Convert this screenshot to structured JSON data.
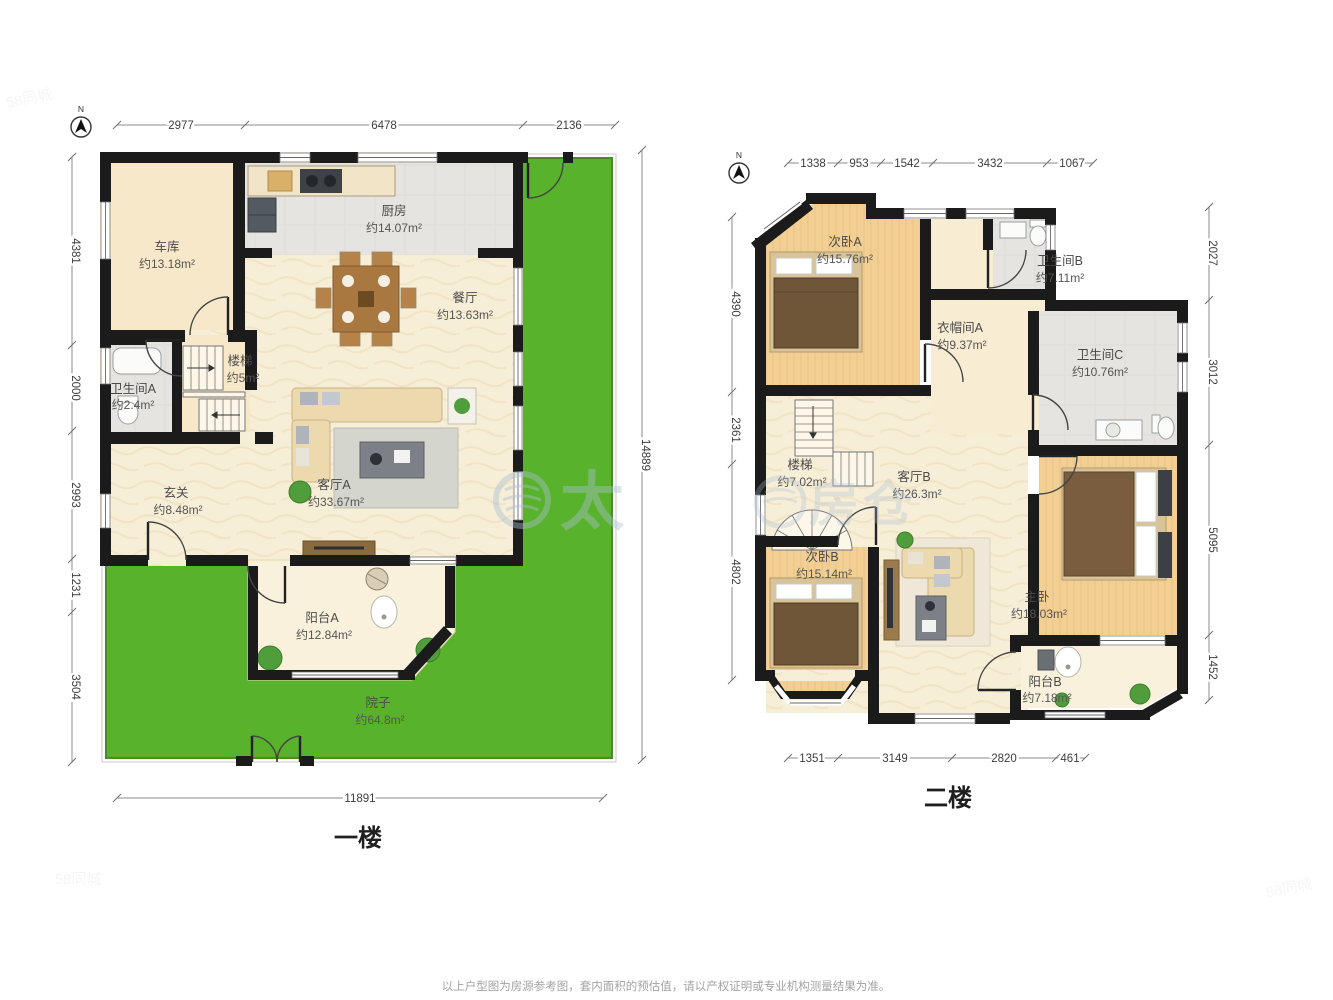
{
  "page": {
    "disclaimer": "以上户型图为房源参考图，套内面积的预估值，请以产权证明或专业机构测量结果为准。",
    "watermark": {
      "left_char": "太",
      "right_char_1": "房",
      "right_char_2": "仓",
      "corner_mark": "58同城"
    }
  },
  "floor1": {
    "title": "一楼",
    "compass": "N",
    "dims_top": [
      "2977",
      "6478",
      "2136"
    ],
    "dims_left": [
      "4381",
      "2000",
      "2993",
      "1231",
      "3504"
    ],
    "dim_right": "14889",
    "dim_bottom": "11891",
    "rooms": {
      "garage": {
        "name": "车库",
        "area": "约13.18m²"
      },
      "kitchen": {
        "name": "厨房",
        "area": "约14.07m²"
      },
      "dining": {
        "name": "餐厅",
        "area": "约13.63m²"
      },
      "stairs": {
        "name": "楼梯",
        "area": "约5m²"
      },
      "bath_a": {
        "name": "卫生间A",
        "area": "约2.4m²"
      },
      "foyer": {
        "name": "玄关",
        "area": "约8.48m²"
      },
      "living_a": {
        "name": "客厅A",
        "area": "约33.67m²"
      },
      "balcony_a": {
        "name": "阳台A",
        "area": "约12.84m²"
      },
      "yard": {
        "name": "院子",
        "area": "约64.8m²"
      }
    }
  },
  "floor2": {
    "title": "二楼",
    "compass": "N",
    "dims_top": [
      "1338",
      "953",
      "1542",
      "3432",
      "1067"
    ],
    "dims_left": [
      "4390",
      "2361",
      "4802"
    ],
    "dims_right": [
      "2027",
      "3012",
      "5095",
      "1452"
    ],
    "dims_bottom": [
      "1351",
      "3149",
      "2820",
      "461"
    ],
    "rooms": {
      "bed_a": {
        "name": "次卧A",
        "area": "约15.76m²"
      },
      "bath_b": {
        "name": "卫生间B",
        "area": "约7.11m²"
      },
      "closet_a": {
        "name": "衣帽间A",
        "area": "约9.37m²"
      },
      "bath_c": {
        "name": "卫生间C",
        "area": "约10.76m²"
      },
      "stairs": {
        "name": "楼梯",
        "area": "约7.02m²"
      },
      "living_b": {
        "name": "客厅B",
        "area": "约26.3m²"
      },
      "bed_b": {
        "name": "次卧B",
        "area": "约15.14m²"
      },
      "master": {
        "name": "主卧",
        "area": "约18.03m²"
      },
      "balcony_b": {
        "name": "阳台B",
        "area": "约7.18m²"
      }
    }
  },
  "colors": {
    "grass": "#58b22c",
    "wall": "#1b1b1b",
    "cream": "#f7eed8",
    "gray_room": "#e5e4e0",
    "wood": "#f2cf92",
    "beige": "#f7e8c9",
    "balcony": "#faf1dc"
  }
}
